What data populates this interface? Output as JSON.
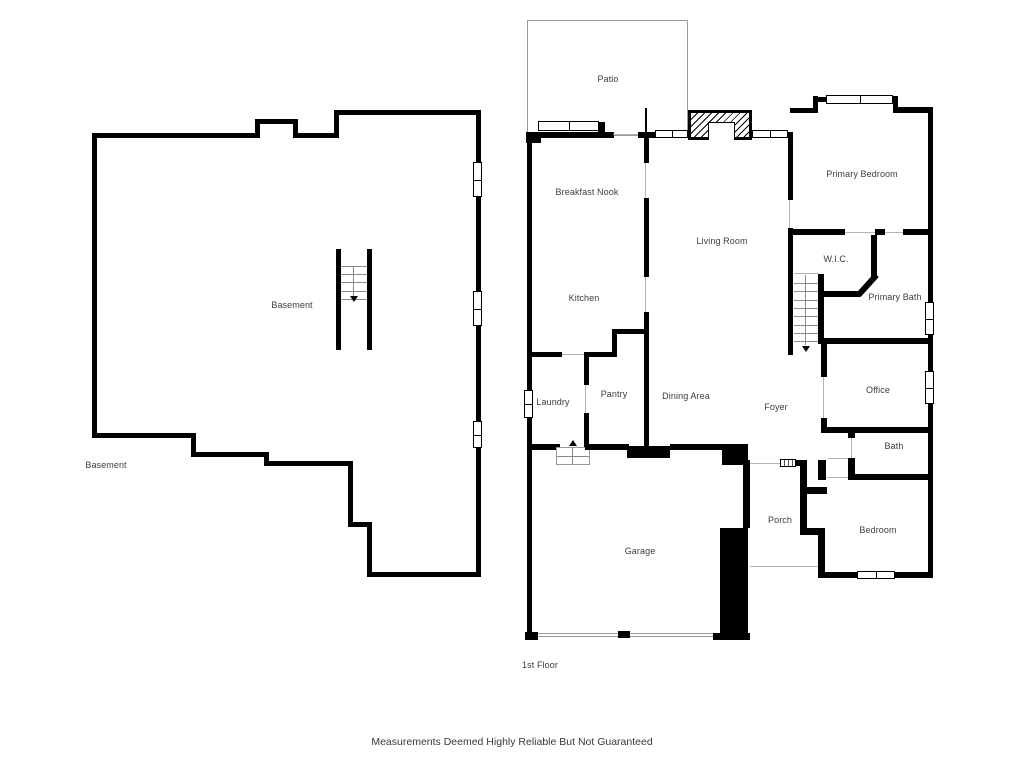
{
  "page": {
    "background_color": "#ffffff",
    "wall_color": "#000000",
    "label_color": "#3d3d3d"
  },
  "plans": {
    "basement": {
      "labels": {
        "main": "Basement",
        "outer": "Basement"
      }
    },
    "first_floor": {
      "rooms": {
        "patio": "Patio",
        "breakfast_nook": "Breakfast Nook",
        "kitchen": "Kitchen",
        "living_room": "Living Room",
        "primary_bedroom": "Primary Bedroom",
        "wic": "W.I.C.",
        "primary_bath": "Primary Bath",
        "laundry": "Laundry",
        "pantry": "Pantry",
        "dining_area": "Dining Area",
        "foyer": "Foyer",
        "office": "Office",
        "bath": "Bath",
        "porch": "Porch",
        "bedroom": "Bedroom",
        "garage": "Garage"
      },
      "floor_label": "1st Floor"
    }
  },
  "footer": {
    "disclaimer": "Measurements Deemed Highly Reliable But Not Guaranteed"
  }
}
